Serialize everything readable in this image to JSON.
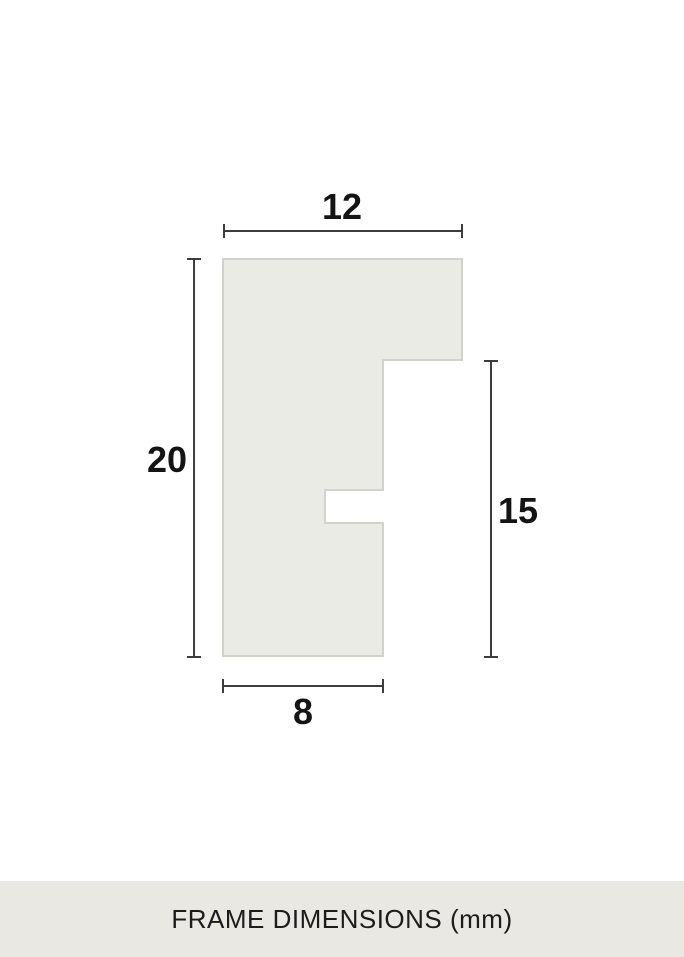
{
  "diagram": {
    "description": "frame-profile-cross-section",
    "dimensions": {
      "top_width": {
        "label": "12"
      },
      "left_height": {
        "label": "20"
      },
      "right_height": {
        "label": "15"
      },
      "bottom_width": {
        "label": "8"
      }
    }
  },
  "footer": {
    "caption": "FRAME DIMENSIONS (mm)"
  },
  "colors": {
    "background": "#ffffff",
    "shape_fill": "#ebebe6",
    "shape_stroke": "#d2d1cc",
    "dimension_line": "#3d3d3d",
    "number_text": "#141414",
    "footer_background": "#e9e8e3",
    "footer_text": "#1c1c1c"
  }
}
